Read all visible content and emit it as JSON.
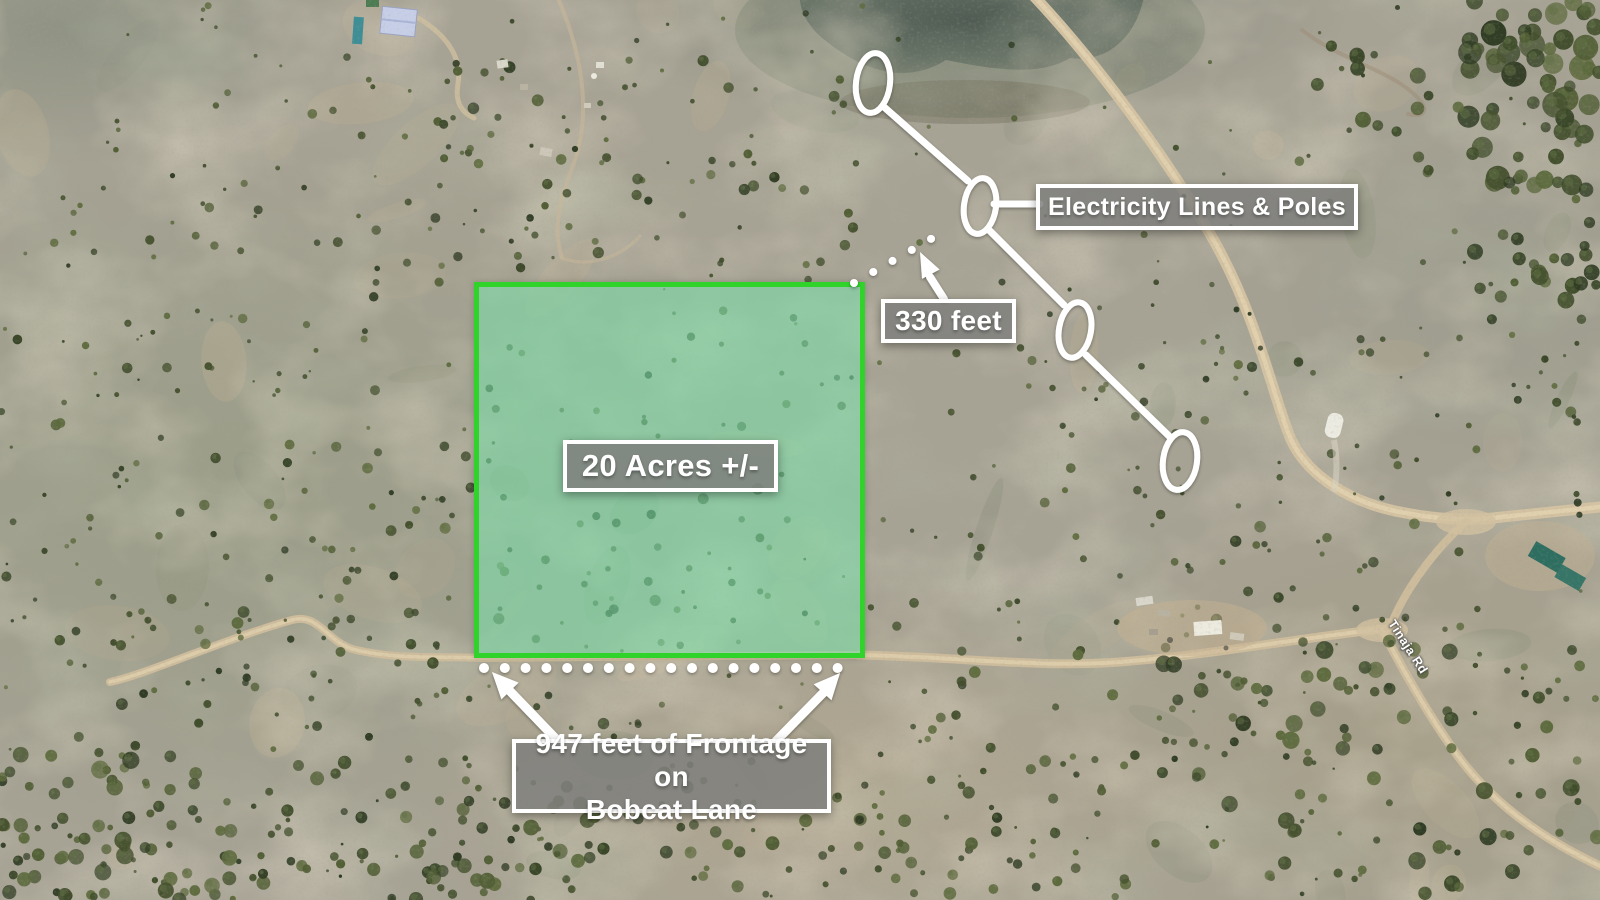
{
  "annotations": {
    "acreage": {
      "label": "20 Acres +/-"
    },
    "electricity": {
      "label": "Electricity Lines & Poles"
    },
    "power_distance": {
      "label": "330 feet"
    },
    "frontage": {
      "line1": "947 feet of Frontage on",
      "line2": "Bobcat Lane"
    },
    "road": {
      "label": "Tinaja Rd"
    }
  },
  "colors": {
    "parcel_border": "#30d32a",
    "parcel_fill": "rgba(123,222,168,0.58)",
    "callout_background": "rgba(127,127,125,0.85)",
    "callout_border": "#ffffff",
    "callout_text": "#ffffff",
    "annotation_marks": "#ffffff"
  }
}
